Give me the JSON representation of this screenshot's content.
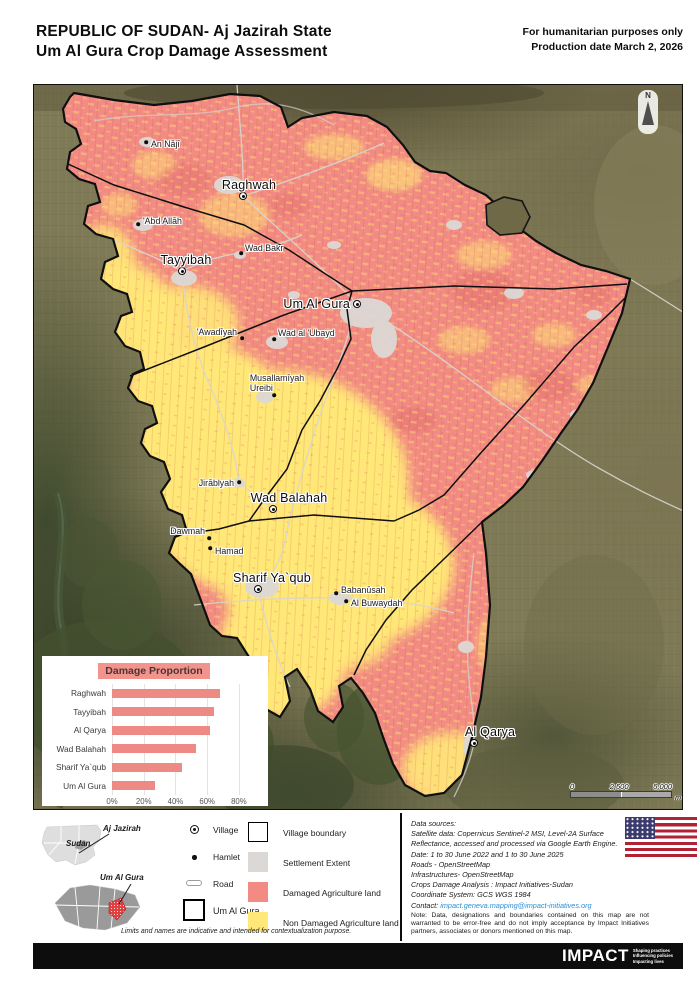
{
  "header": {
    "title_line1": "REPUBLIC OF SUDAN- Aj Jazirah State",
    "title_line2": "Um Al Gura Crop Damage Assessment",
    "right_line1": "For humanitarian purposes only",
    "right_line2": "Production date March 2, 2026"
  },
  "map": {
    "north_label": "N",
    "scalebar": {
      "ticks": [
        "0",
        "2,500",
        "5,000"
      ],
      "unit": "m"
    },
    "villages": [
      {
        "name": "Raghwah",
        "x": 209,
        "y": 111,
        "side": "above",
        "dx": 6,
        "dy": -4
      },
      {
        "name": "Tayyibah",
        "x": 148,
        "y": 186,
        "side": "above",
        "dx": 4,
        "dy": -4
      },
      {
        "name": "Um Al Gura",
        "x": 323,
        "y": 219,
        "side": "left",
        "dx": -7,
        "dy": 0
      },
      {
        "name": "Wad Balahah",
        "x": 239,
        "y": 424,
        "side": "above",
        "dx": 16,
        "dy": -4
      },
      {
        "name": "Sharif Ya`qub",
        "x": 224,
        "y": 504,
        "side": "above",
        "dx": 14,
        "dy": -4
      },
      {
        "name": "Al Qarya",
        "x": 440,
        "y": 658,
        "side": "above",
        "dx": 16,
        "dy": -4
      }
    ],
    "hamlets": [
      {
        "name": "An Nājī",
        "x": 112,
        "y": 57,
        "side": "right",
        "dx": 5,
        "dy": 2
      },
      {
        "name": "'Abd Allāh",
        "x": 104,
        "y": 139,
        "side": "right",
        "dx": 5,
        "dy": -3
      },
      {
        "name": "Wad Bakr",
        "x": 207,
        "y": 168,
        "side": "right",
        "dx": 4,
        "dy": -5
      },
      {
        "name": "'Awadīyah",
        "x": 208,
        "y": 253,
        "side": "left",
        "dx": -5,
        "dy": -6
      },
      {
        "name": "Wad al 'Ubayd",
        "x": 240,
        "y": 254,
        "side": "right",
        "dx": 4,
        "dy": -6
      },
      {
        "name": "Musallamīyah\nUreibi",
        "x": 240,
        "y": 310,
        "side": "above",
        "dx": 3,
        "dy": -2
      },
      {
        "name": "Jirāblyah",
        "x": 205,
        "y": 397,
        "side": "left",
        "dx": -5,
        "dy": 1
      },
      {
        "name": "Dawmah",
        "x": 175,
        "y": 453,
        "side": "left",
        "dx": -4,
        "dy": -7
      },
      {
        "name": "Hamad",
        "x": 176,
        "y": 463,
        "side": "right",
        "dx": 5,
        "dy": 3
      },
      {
        "name": "Babanūsah",
        "x": 302,
        "y": 508,
        "side": "right",
        "dx": 5,
        "dy": -3
      },
      {
        "name": "Al Buwaydah",
        "x": 312,
        "y": 516,
        "side": "right",
        "dx": 5,
        "dy": 2
      }
    ]
  },
  "chart_data": {
    "type": "bar",
    "orientation": "horizontal",
    "title": "Damage Proportion",
    "categories": [
      "Raghwah",
      "Tayyibah",
      "Al Qarya",
      "Wad Balahah",
      "Sharif Ya`qub",
      "Um Al Gura"
    ],
    "values": [
      68,
      64,
      62,
      53,
      44,
      27
    ],
    "unit": "%",
    "xlabel": "",
    "ylabel": "",
    "xlim": [
      0,
      80
    ],
    "axis_max": 87,
    "gridlines": [
      0,
      20,
      40,
      60,
      80
    ],
    "ticks": [
      "0%",
      "20%",
      "40%",
      "60%",
      "80%"
    ],
    "bar_color": "#ee8a84",
    "legend_position": "none",
    "grid": true
  },
  "legend": {
    "insets": {
      "country_label": "Sudan",
      "state_label": "Aj Jazirah",
      "locality_label": "Um Al Gura"
    },
    "symbols": [
      {
        "label": "Village"
      },
      {
        "label": "Hamlet"
      },
      {
        "label": "Road"
      },
      {
        "label": "Um Al Gura"
      }
    ],
    "swatches": [
      {
        "label": "Village boundary",
        "color": "#ffffff"
      },
      {
        "label": "Settlement  Extent",
        "color": "#dcd8d5"
      },
      {
        "label": "Damaged Agriculture land",
        "color": "#f28b84"
      },
      {
        "label": "Non Damaged Agriculture land",
        "color": "#ffe878"
      }
    ],
    "note": "Limits and names are indicative and intended for contextualization purpose."
  },
  "sources": {
    "lines": [
      "Data sources:",
      "Satellite data: Copernicus Sentinel-2 MSI, Level-2A Surface",
      "Reflectance, accessed and processed via Google Earth Engine.",
      "Date:  1 to 30 June 2022 and 1 to 30 June 2025",
      "Roads - OpenStreetMap",
      "Infrastructures- OpenStreetMap",
      "Crops Damage Analysis : Impact Initiatives-Sudan",
      "Coordinate System: GCS WGS 1984"
    ],
    "contact_label": "Contact: ",
    "contact_email": "impact.geneva.mapping@impact-initiatives.org",
    "note": "Note: Data, designations and boundaries contained on this map are not warranted to be error-free and do not imply acceptance by Impact Initiatives partners, associates or donors mentioned on this map."
  },
  "footer": {
    "logo": "IMPACT",
    "tagline": [
      "Shaping practices",
      "Influencing policies",
      "Impacting lives"
    ]
  },
  "colors": {
    "damaged": "#f28b84",
    "non_damaged": "#ffe878",
    "settlement": "#dcd8d5",
    "boundary": "#0f0f0f",
    "road": "#d7d6d0"
  }
}
